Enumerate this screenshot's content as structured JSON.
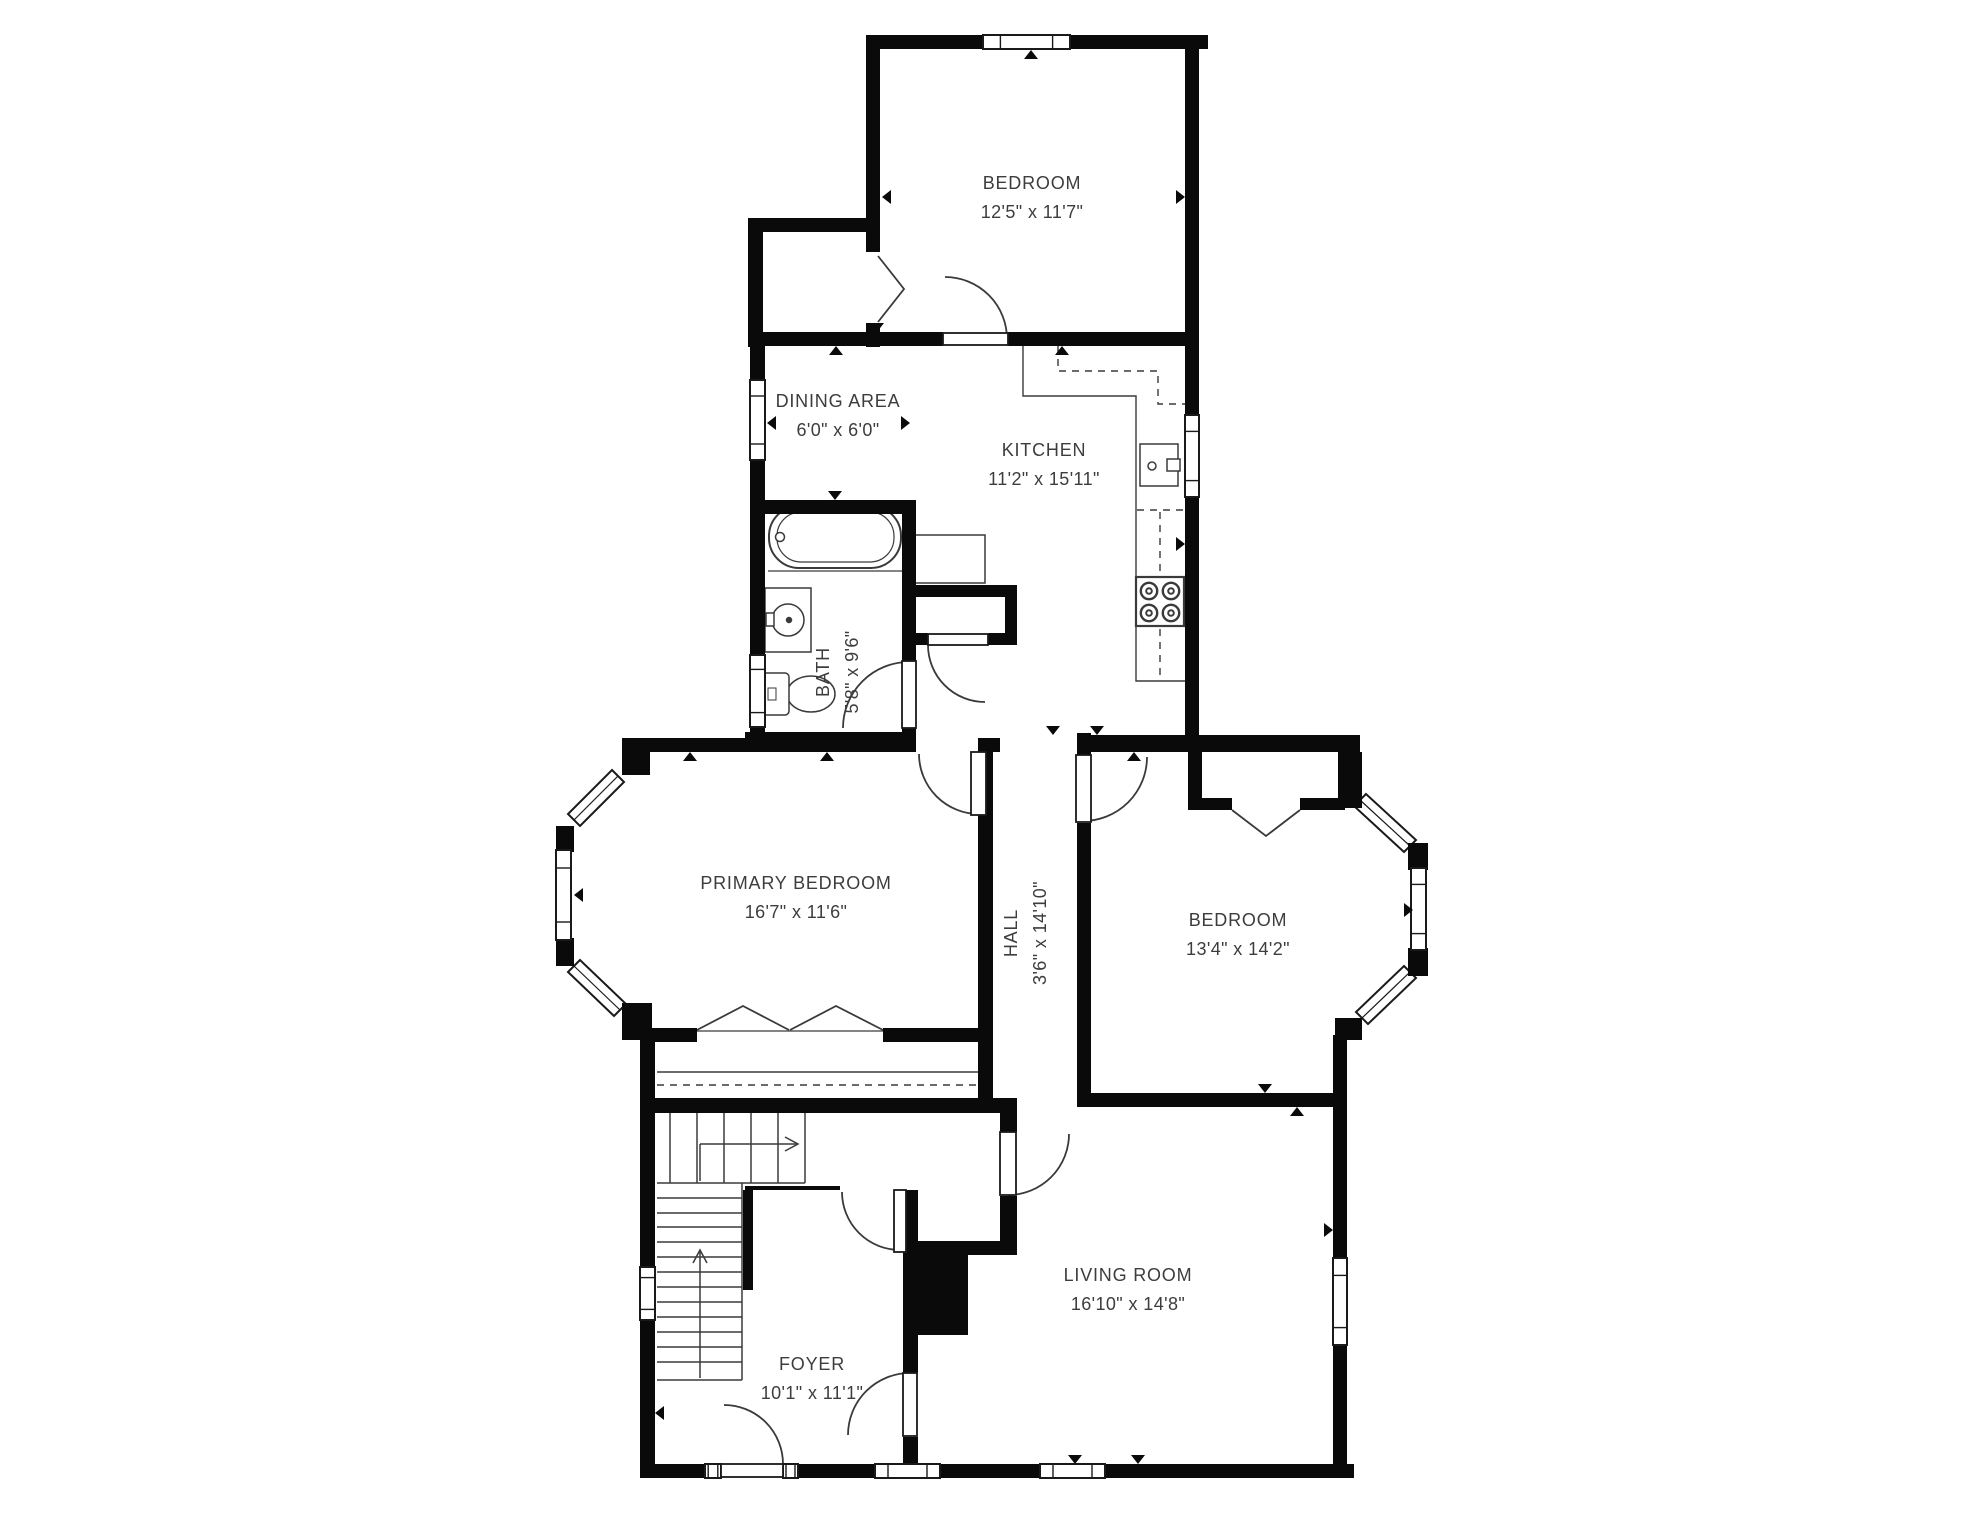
{
  "title": "Apartment floor plan",
  "colors": {
    "background": "#ffffff",
    "wall": "#0a0a0a",
    "thin_line": "#3a3a3a",
    "text": "#3d3d3d"
  },
  "rooms": [
    {
      "id": "bedroom-top",
      "name": "BEDROOM",
      "dims": "12'5\" x 11'7\"",
      "rotated": false
    },
    {
      "id": "dining-area",
      "name": "DINING AREA",
      "dims": "6'0\" x 6'0\"",
      "rotated": false
    },
    {
      "id": "kitchen",
      "name": "KITCHEN",
      "dims": "11'2\" x 15'11\"",
      "rotated": false
    },
    {
      "id": "bath",
      "name": "BATH",
      "dims": "5'8\" x 9'6\"",
      "rotated": true
    },
    {
      "id": "primary-bedroom",
      "name": "PRIMARY BEDROOM",
      "dims": "16'7\" x 11'6\"",
      "rotated": false
    },
    {
      "id": "hall",
      "name": "HALL",
      "dims": "3'6\" x 14'10\"",
      "rotated": true
    },
    {
      "id": "bedroom-right",
      "name": "BEDROOM",
      "dims": "13'4\" x 14'2\"",
      "rotated": false
    },
    {
      "id": "living-room",
      "name": "LIVING ROOM",
      "dims": "16'10\" x 14'8\"",
      "rotated": false
    },
    {
      "id": "foyer",
      "name": "FOYER",
      "dims": "10'1\" x 11'1\"",
      "rotated": false
    }
  ],
  "fixtures": [
    "bathtub",
    "vanity-sink",
    "toilet",
    "kitchen-sink",
    "stove",
    "refrigerator",
    "pantry-closet",
    "fireplace",
    "staircase",
    "stair-direction-arrow",
    "front-door",
    "door-swing",
    "bifold-closet-door",
    "window",
    "bay-window"
  ]
}
